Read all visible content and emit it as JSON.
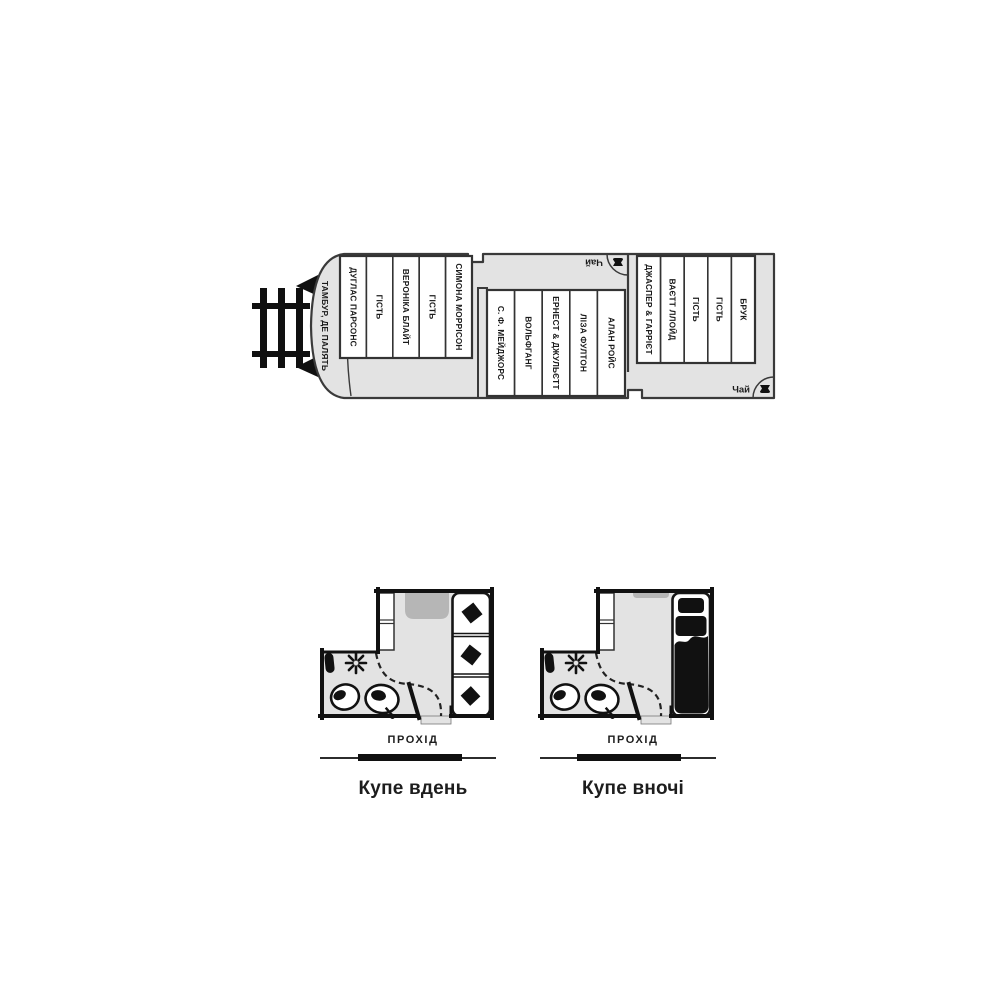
{
  "diagram": {
    "train": {
      "vestibule": "ТАМБУР, ДЕ ПАЛЯТЬ",
      "tea_top": "Чай",
      "tea_bottom": "Чай",
      "front_compartments": [
        "ДУГЛАС ПАРСОНС",
        "ГІСТЬ",
        "ВЕРОНІКА БЛАЙТ",
        "ГІСТЬ",
        "СИМОНА МОРРІСОН"
      ],
      "middle_compartments": [
        "С. Ф. МЕЙДЖОРС",
        "ВОЛЬФГАНГ",
        "ЕРНЕСТ & ДЖУЛЬЄТТ",
        "ЛІЗА ФУЛТОН",
        "АЛАН РОЙС"
      ],
      "rear_compartments": [
        "ДЖАСПЕР & ГАРРІЄТ",
        "ВАЄТТ ЛЛОЙД",
        "ГІСТЬ",
        "ГІСТЬ",
        "БРУК"
      ]
    },
    "day_plan": {
      "corridor": "ПРОХІД",
      "caption": "Купе вдень"
    },
    "night_plan": {
      "corridor": "ПРОХІД",
      "caption": "Купе вночі"
    }
  },
  "colors": {
    "car_fill": "#e3e3e3",
    "wall_ink": "#111111",
    "outline": "#3a3a3a",
    "furniture_gray": "#b6b6b6"
  }
}
